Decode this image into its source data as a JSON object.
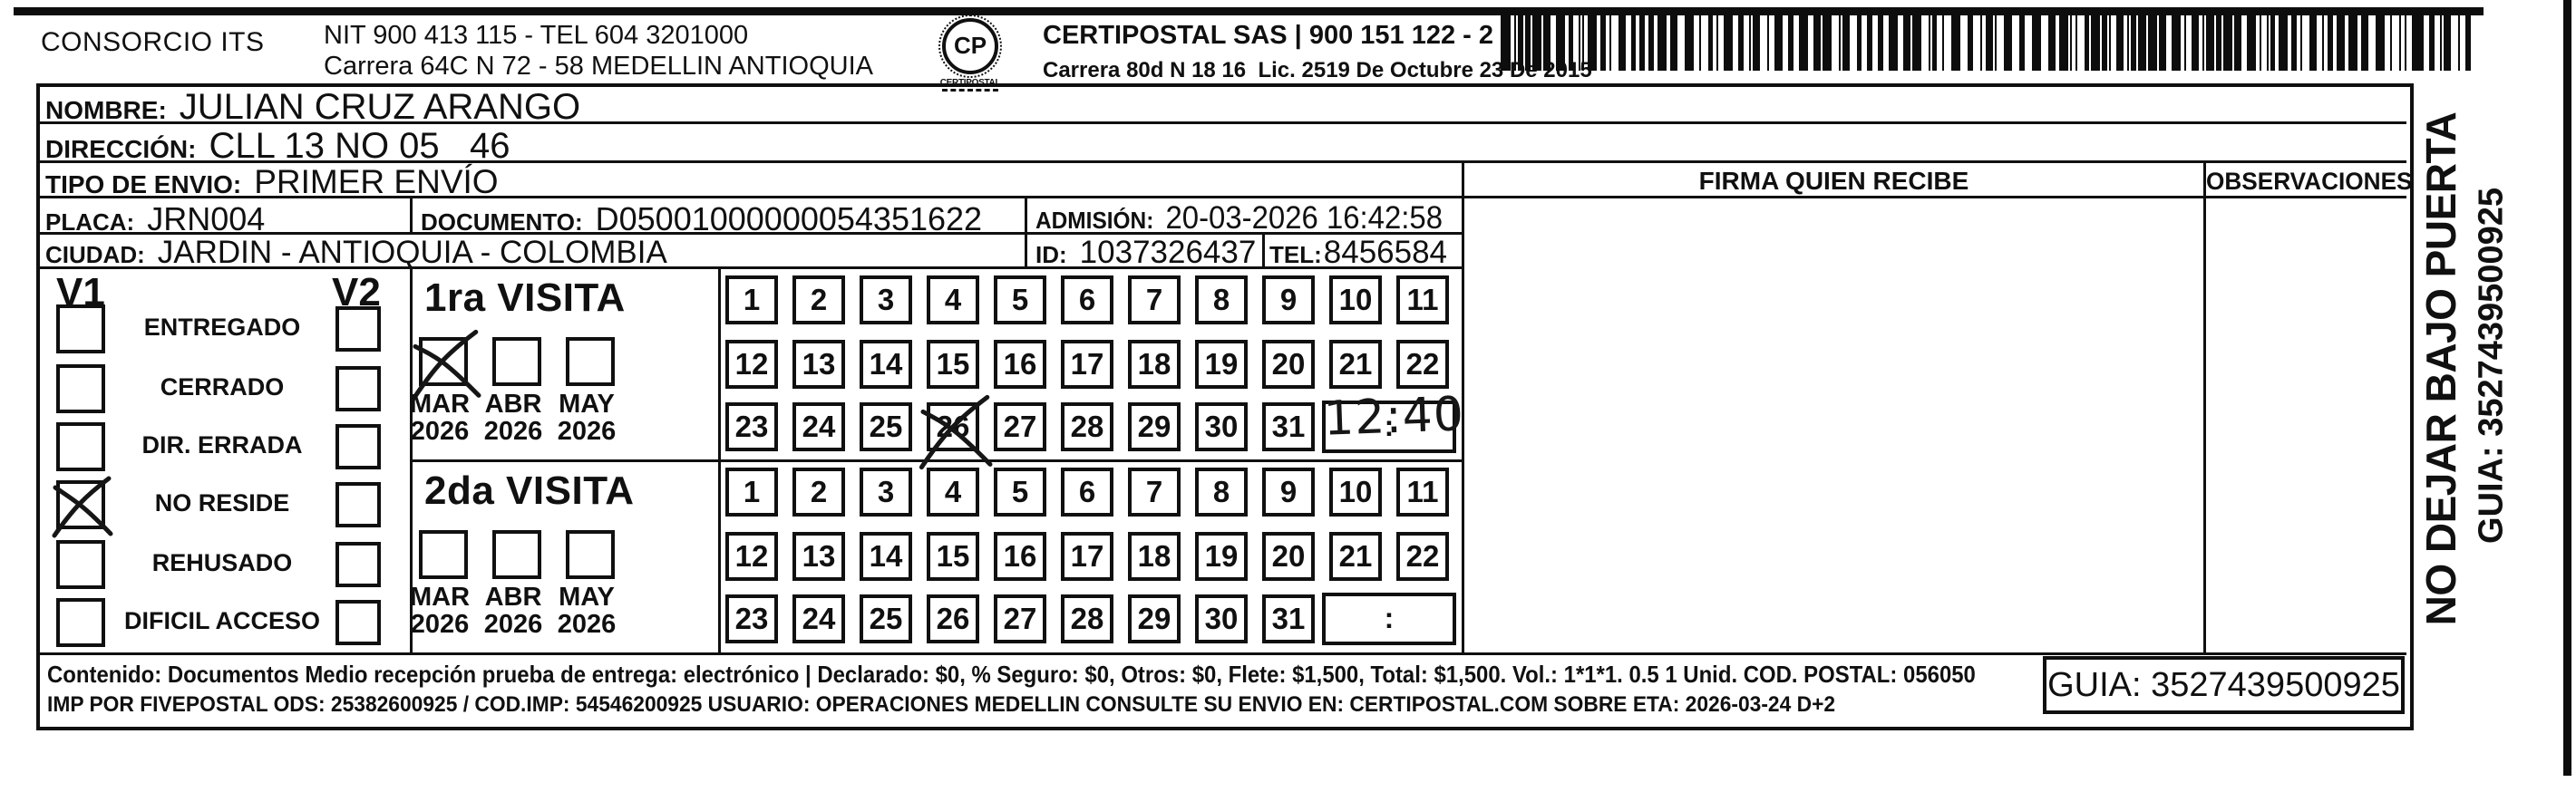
{
  "header": {
    "consorcio": "CONSORCIO ITS",
    "nit_line1": "NIT 900 413 115 - TEL 604 3201000",
    "nit_line2": "Carrera 64C N 72 - 58 MEDELLIN ANTIOQUIA",
    "logo_glyph": "CP",
    "logo_text": "CERTIPOSTAL",
    "certipostal_line1": "CERTIPOSTAL SAS | 900 151 122 - 2",
    "certipostal_line2": "Carrera 80d N 18 16  Lic. 2519 De Octubre 23 De 2015"
  },
  "recipient": {
    "nombre_label": "NOMBRE:",
    "nombre": "JULIAN CRUZ ARANGO",
    "direccion_label": "DIRECCIÓN:",
    "direccion": "CLL 13 NO 05   46",
    "tipo_label": "TIPO DE ENVIO:",
    "tipo": "PRIMER ENVÍO",
    "placa_label": "PLACA:",
    "placa": "JRN004",
    "documento_label": "DOCUMENTO:",
    "documento": "D05001000000054351622",
    "admision_label": "ADMISIÓN:",
    "admision": "20-03-2026 16:42:58",
    "ciudad_label": "CIUDAD:",
    "ciudad": "JARDIN - ANTIOQUIA - COLOMBIA",
    "id_label": "ID:",
    "id_value": "1037326437",
    "tel_label": "TEL:",
    "tel": "8456584"
  },
  "right_panel": {
    "firma_header": "FIRMA QUIEN RECIBE",
    "observaciones_header": "OBSERVACIONES"
  },
  "status_panel": {
    "col1": "V1",
    "col2": "V2",
    "rows": [
      {
        "label": "ENTREGADO",
        "v1": false,
        "v2": false
      },
      {
        "label": "CERRADO",
        "v1": false,
        "v2": false
      },
      {
        "label": "DIR. ERRADA",
        "v1": false,
        "v2": false
      },
      {
        "label": "NO RESIDE",
        "v1": true,
        "v2": false
      },
      {
        "label": "REHUSADO",
        "v1": false,
        "v2": false
      },
      {
        "label": "DIFICIL ACCESO",
        "v1": false,
        "v2": false
      }
    ]
  },
  "visits": [
    {
      "title": "1ra VISITA",
      "months": [
        {
          "label": "MAR",
          "year": "2026",
          "checked": true
        },
        {
          "label": "ABR",
          "year": "2026",
          "checked": false
        },
        {
          "label": "MAY",
          "year": "2026",
          "checked": false
        }
      ],
      "day_rows": [
        [
          1,
          2,
          3,
          4,
          5,
          6,
          7,
          8,
          9,
          10,
          11
        ],
        [
          12,
          13,
          14,
          15,
          16,
          17,
          18,
          19,
          20,
          21,
          22
        ],
        [
          23,
          24,
          25,
          26,
          27,
          28,
          29,
          30,
          31
        ]
      ],
      "crossed_day": 26,
      "time_placeholder": ":",
      "time_written": "12:40"
    },
    {
      "title": "2da VISITA",
      "months": [
        {
          "label": "MAR",
          "year": "2026",
          "checked": false
        },
        {
          "label": "ABR",
          "year": "2026",
          "checked": false
        },
        {
          "label": "MAY",
          "year": "2026",
          "checked": false
        }
      ],
      "day_rows": [
        [
          1,
          2,
          3,
          4,
          5,
          6,
          7,
          8,
          9,
          10,
          11
        ],
        [
          12,
          13,
          14,
          15,
          16,
          17,
          18,
          19,
          20,
          21,
          22
        ],
        [
          23,
          24,
          25,
          26,
          27,
          28,
          29,
          30,
          31
        ]
      ],
      "crossed_day": null,
      "time_placeholder": ":",
      "time_written": ""
    }
  ],
  "side_note": {
    "line1": "NO DEJAR BAJO PUERTA",
    "line2": "GUIA: 3527439500925"
  },
  "footer": {
    "line1": "Contenido: Documentos Medio recepción prueba de entrega: electrónico | Declarado: $0, % Seguro: $0, Otros: $0, Flete: $1,500, Total: $1,500. Vol.: 1*1*1. 0.5  1 Unid. COD. POSTAL: 056050",
    "line2": "IMP POR FIVEPOSTAL ODS: 25382600925 / COD.IMP: 54546200925 USUARIO: OPERACIONES MEDELLIN CONSULTE SU ENVIO EN: CERTIPOSTAL.COM SOBRE ETA: 2026-03-24 D+2",
    "guia": "GUIA: 3527439500925"
  },
  "colors": {
    "ink": "#101010",
    "paper": "#ffffff"
  }
}
